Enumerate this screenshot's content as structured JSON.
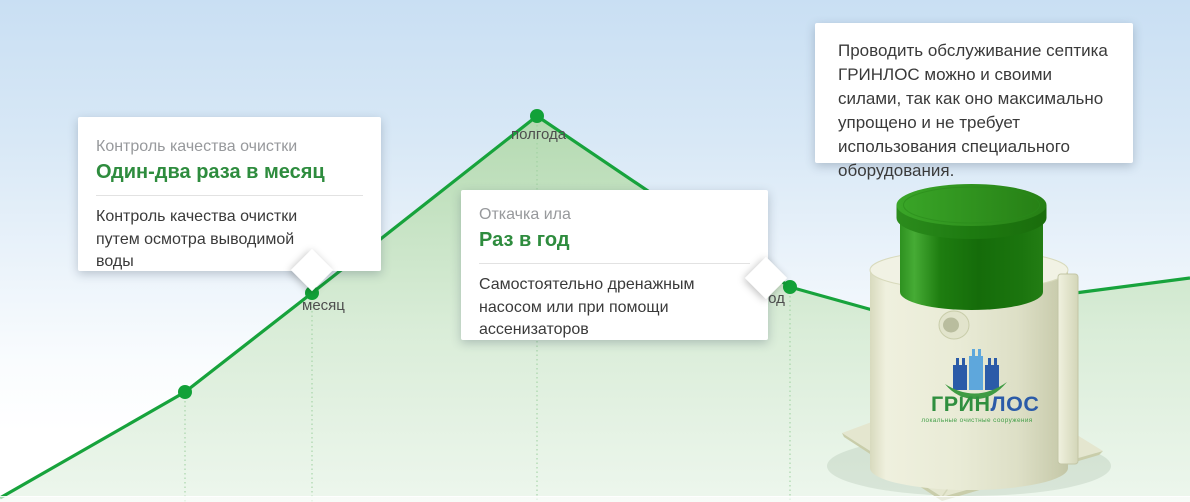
{
  "cards": {
    "quality": {
      "title": "Контроль качества очистки",
      "frequency": "Один-два раза в месяц",
      "description": "Контроль качества очистки путем осмотра выводимой воды"
    },
    "pumping": {
      "title": "Откачка ила",
      "frequency": "Раз в год",
      "description": "Самостоятельно дренажным насосом или при помощи ассенизаторов"
    },
    "note": {
      "text": "Проводить обслуживание септика ГРИНЛОС можно и своими силами, так как оно максимально упрощено и не требует использования специального оборудования."
    }
  },
  "chart_data": {
    "type": "line",
    "title": "",
    "milestones": [
      {
        "label": "",
        "x": 185,
        "y": 392
      },
      {
        "label": "месяц",
        "x": 312,
        "y": 293
      },
      {
        "label": "полгода",
        "x": 537,
        "y": 116
      },
      {
        "label": "год",
        "x": 790,
        "y": 287
      }
    ],
    "legend": "none",
    "grid": "dotted vertical guides under milestone points"
  },
  "tank": {
    "brand_green": "ГРИН",
    "brand_blue": "ЛОС",
    "tagline": "локальные очистные сооружения"
  },
  "colors": {
    "line_green": "#17a33c",
    "accent_green": "#2e8c3e",
    "title_gray": "#97999c",
    "body_text": "#3a3a3a",
    "brand_blue": "#2b5ba8",
    "sky_top": "#c9dff3",
    "fill_green_top": "#b2d9ad",
    "fill_green_bottom": "#ecf6ec"
  }
}
